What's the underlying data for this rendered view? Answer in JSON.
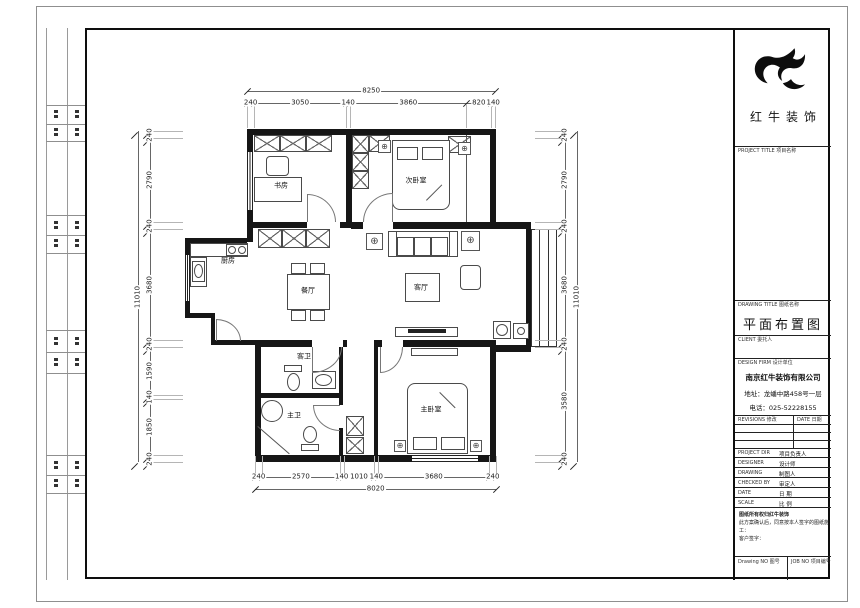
{
  "title_block": {
    "brand": "红牛装饰",
    "project_title_label": "PROJECT TITLE 项目名称",
    "drawing_title_label": "DRAWING TITLE 图纸名称",
    "drawing_title": "平面布置图",
    "client_label": "CLIENT 委托人",
    "design_firm_label": "DESIGN FIRM 设计单位",
    "firm_name": "南京红牛装饰有限公司",
    "firm_address": "地址：龙蟠中路458号一层",
    "firm_phone": "电话：025-52228155",
    "revisions_label": "REVISIONS 修改",
    "revisions_date_label": "DATE 日期",
    "rows": [
      {
        "en": "PROJECT DIR",
        "zh": "项目负责人"
      },
      {
        "en": "DESIGNER",
        "zh": "设计师"
      },
      {
        "en": "DRAWING",
        "zh": "制图人"
      },
      {
        "en": "CHECKED BY",
        "zh": "审定人"
      },
      {
        "en": "DATE",
        "zh": "日 期"
      },
      {
        "en": "SCALE",
        "zh": "比 例"
      }
    ],
    "notes": [
      "图纸所有权归红牛装饰",
      "此方案确认后，同意按本人签字的图纸施工：",
      "客户签字："
    ],
    "drawing_no_label": "Drawing NO 图号",
    "job_no_label": "JOB NO 项目编号"
  },
  "plan": {
    "rooms": {
      "study": "书房",
      "bedroom2": "次卧室",
      "kitchen": "厨房",
      "dining": "餐厅",
      "living": "客厅",
      "bath1": "客卫",
      "bath2": "主卫",
      "master": "主卧室"
    },
    "symbols": {
      "lamp": "⊕"
    },
    "dimensions": {
      "top": {
        "segments": [
          240,
          3050,
          140,
          3860,
          820,
          140
        ],
        "overall": 8250
      },
      "bottom": {
        "segments": [
          240,
          2570,
          140,
          1010,
          140,
          3680,
          240
        ],
        "overall": 8020
      },
      "left": {
        "segments": [
          240,
          2790,
          240,
          3680,
          240,
          1590,
          140,
          1850,
          240
        ],
        "overall": 11010
      },
      "right": {
        "segments": [
          240,
          2790,
          240,
          3680,
          240,
          3580,
          240
        ],
        "overall": 11010
      }
    }
  }
}
